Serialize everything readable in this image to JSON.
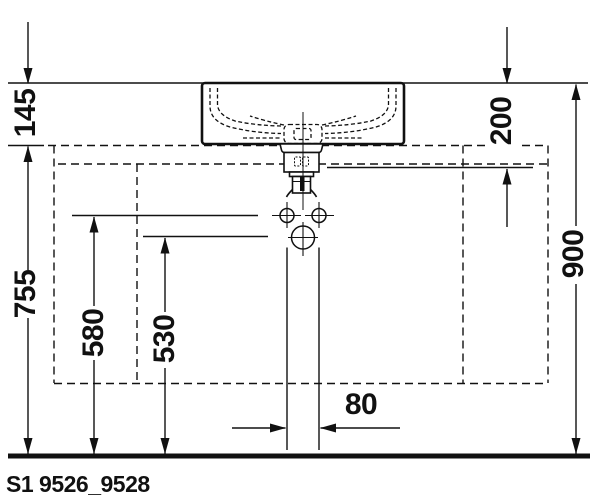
{
  "drawing": {
    "code": "S1 9526_9528",
    "colors": {
      "line": "#111111",
      "background": "#ffffff"
    },
    "dimensions_mm": {
      "basin_height": "145",
      "floor_to_counter": "755",
      "supply_connection_height": "580",
      "drain_connection_height": "530",
      "rim_to_connection_zone": "200",
      "floor_to_rim": "900",
      "supply_pipe_spacing": "80"
    }
  }
}
